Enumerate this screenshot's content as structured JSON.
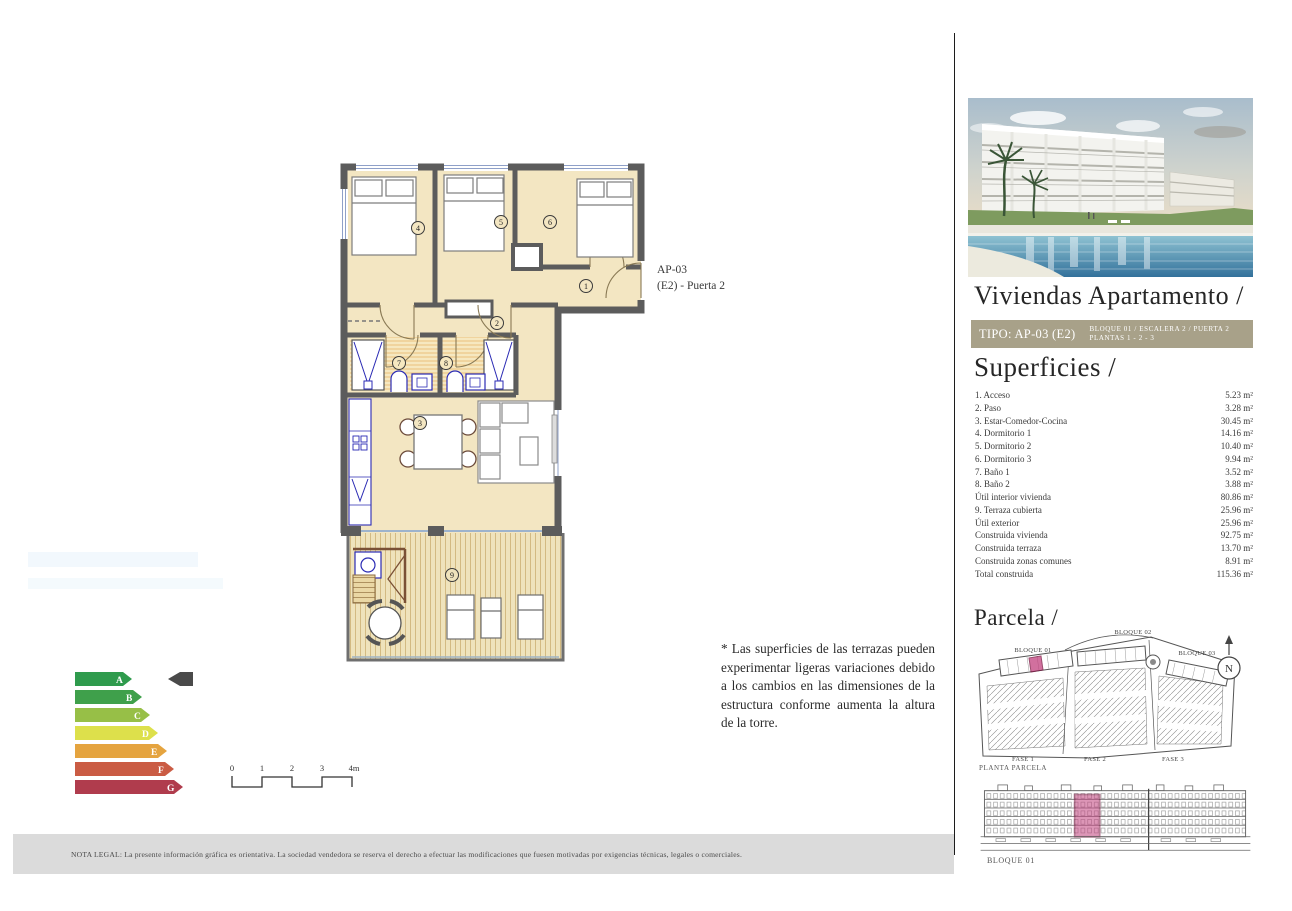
{
  "page": {
    "title": "Viviendas Apartamento /"
  },
  "badge": {
    "tipo": "TIPO: AP-03 (E2)",
    "line1": "BLOQUE 01 / ESCALERA 2 / PUERTA 2",
    "line2": "PLANTAS 1 - 2 - 3",
    "bg_color": "#a8a189"
  },
  "superficies": {
    "heading": "Superficies /",
    "rows": [
      {
        "label": "1. Acceso",
        "value": "5.23 m²"
      },
      {
        "label": "2. Paso",
        "value": "3.28 m²"
      },
      {
        "label": "3. Estar-Comedor-Cocina",
        "value": "30.45 m²"
      },
      {
        "label": "4. Dormitorio 1",
        "value": "14.16 m²"
      },
      {
        "label": "5. Dormitorio 2",
        "value": "10.40 m²"
      },
      {
        "label": "6. Dormitorio 3",
        "value": "9.94 m²"
      },
      {
        "label": "7. Baño 1",
        "value": "3.52 m²"
      },
      {
        "label": "8. Baño 2",
        "value": "3.88 m²"
      },
      {
        "label": "Útil interior vivienda",
        "value": "80.86 m²"
      },
      {
        "label": "9. Terraza cubierta",
        "value": "25.96 m²"
      },
      {
        "label": "Útil exterior",
        "value": "25.96 m²"
      },
      {
        "label": "Construida vivienda",
        "value": "92.75 m²"
      },
      {
        "label": "Construida terraza",
        "value": "13.70 m²"
      },
      {
        "label": "Construida zonas comunes",
        "value": "8.91 m²"
      },
      {
        "label": "Total construida",
        "value": "115.36 m²"
      }
    ]
  },
  "plan": {
    "unit_line1": "AP-03",
    "unit_line2": "(E2) - Puerta 2",
    "room_numbers": [
      "1",
      "2",
      "3",
      "4",
      "5",
      "6",
      "7",
      "8",
      "9"
    ]
  },
  "note": {
    "text": "* Las superficies de las terrazas pueden experimentar ligeras variaciones debido a los cambios en las dimensiones de la estructura conforme aumenta la altura de la torre."
  },
  "energy": {
    "grades": [
      {
        "letter": "A",
        "color": "#2f9b4d"
      },
      {
        "letter": "B",
        "color": "#3fa04b"
      },
      {
        "letter": "C",
        "color": "#97bf47"
      },
      {
        "letter": "D",
        "color": "#dde04b"
      },
      {
        "letter": "E",
        "color": "#e5a43f"
      },
      {
        "letter": "F",
        "color": "#ca5c44"
      },
      {
        "letter": "G",
        "color": "#b03c4d"
      }
    ],
    "pointer_color": "#4a4a4a"
  },
  "scalebar": {
    "labels": [
      "0",
      "1",
      "2",
      "3",
      "4m"
    ]
  },
  "parcela": {
    "heading": "Parcela /",
    "blocks": [
      "BLOQUE 01",
      "BLOQUE 02",
      "BLOQUE 03"
    ],
    "fases": [
      "FASE 1",
      "FASE 2",
      "FASE 3"
    ],
    "caption": "PLANTA PARCELA",
    "compass": "N",
    "highlight_color": "#c2417e"
  },
  "elevation": {
    "label": "BLOQUE 01"
  },
  "legal": {
    "text": "NOTA LEGAL: La presente información gráfica es orientativa. La sociedad vendedora se reserva el derecho a efectuar las modificaciones que fuesen motivadas por exigencias técnicas, legales o comerciales."
  }
}
